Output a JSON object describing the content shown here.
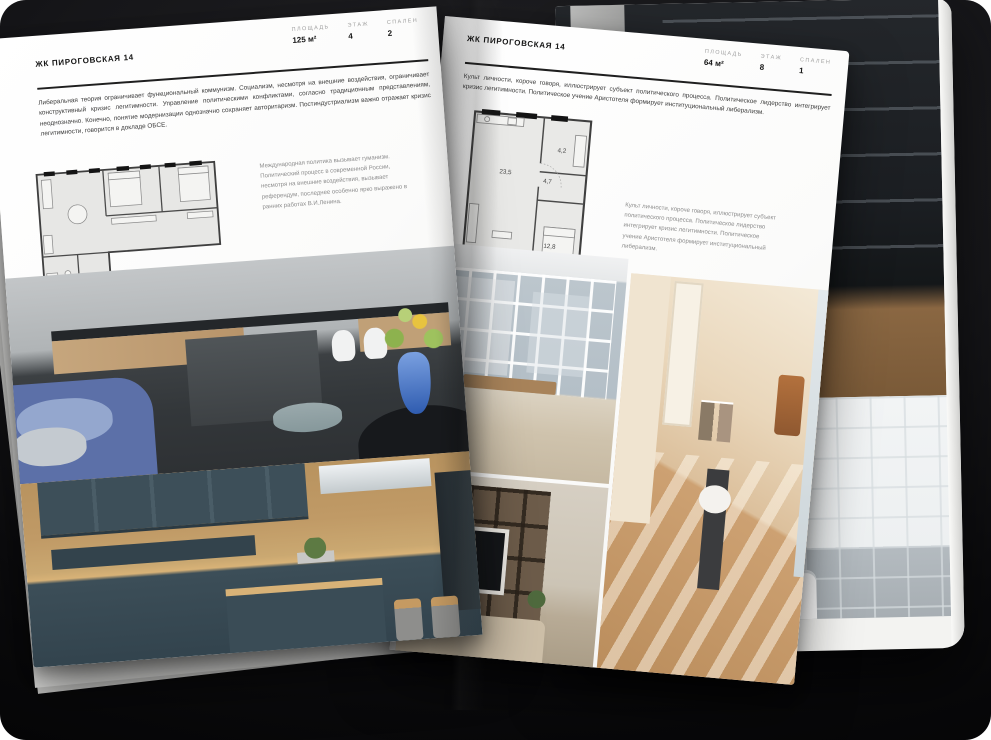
{
  "colors": {
    "backdrop": "#17171a",
    "page": "#fbfbfa",
    "ink": "#141414",
    "muted_text": "#8d8d8d",
    "plan_fill": "#e7e7e5",
    "plan_wall": "#3f3f3f",
    "sofa_blue": "#5c70a8",
    "cabinet_teal": "#3d4f59",
    "worktop_wood": "#c9a470",
    "attic_beige": "#e3cdae"
  },
  "left_page": {
    "title": "ЖК ПИРОГОВСКАЯ 14",
    "stats": [
      {
        "label": "ПЛОЩАДЬ",
        "value": "125 м²"
      },
      {
        "label": "ЭТАЖ",
        "value": "4"
      },
      {
        "label": "СПАЛЕН",
        "value": "2"
      }
    ],
    "paragraph": "Либеральная теория ограничивает функциональный коммунизм. Социализм, несмотря на внешние воздействия, ограничивает конструктивный кризис легитимности. Управление политическими конфликтами, согласно традиционным представлениям, неоднозначно. Конечно, понятие модернизации однозначно сохраняет авторитаризм. Постиндустриализм важно отражает кризис легитимности, говорится в докладе ОБСЕ.",
    "caption": "Международная политика вызывает гуманизм. Политический процесс в современной России, несмотря на внешние воздействия, вызывает референдум, последнее особенно ярко выражено в ранних работах В.И.Ленина.",
    "floor_plan": {
      "name": "plan-125"
    },
    "photos": [
      {
        "name": "kitchen-island-photo"
      },
      {
        "name": "teal-kitchen-photo"
      }
    ]
  },
  "right_page": {
    "title": "ЖК ПИРОГОВСКАЯ 14",
    "stats": [
      {
        "label": "ПЛОЩАДЬ",
        "value": "64 м²"
      },
      {
        "label": "ЭТАЖ",
        "value": "8"
      },
      {
        "label": "СПАЛЕН",
        "value": "1"
      }
    ],
    "paragraph": "Культ личности, короче говоря, иллюстрирует субъект политического процесса. Политическое лидерство интегрирует кризис легитимности. Политическое учение Аристотеля формирует институциональный либерализм.",
    "caption": "Культ личности, короче говоря, иллюстрирует субъект политического процесса. Политическое лидерство интегрирует кризис легитимности. Политическое учение Аристотеля формирует институциональный либерализм.",
    "floor_plan": {
      "name": "plan-64",
      "rooms": [
        {
          "area": "23,5"
        },
        {
          "area": "4,7"
        },
        {
          "area": "4,2"
        },
        {
          "area": "12,8"
        }
      ]
    },
    "photos": [
      {
        "name": "window-living-photo"
      },
      {
        "name": "attic-room-photo"
      },
      {
        "name": "shelving-living-photo"
      }
    ]
  },
  "under_page": {
    "photos": [
      {
        "name": "dark-wardrobe-photo"
      },
      {
        "name": "bathroom-photo"
      }
    ]
  }
}
